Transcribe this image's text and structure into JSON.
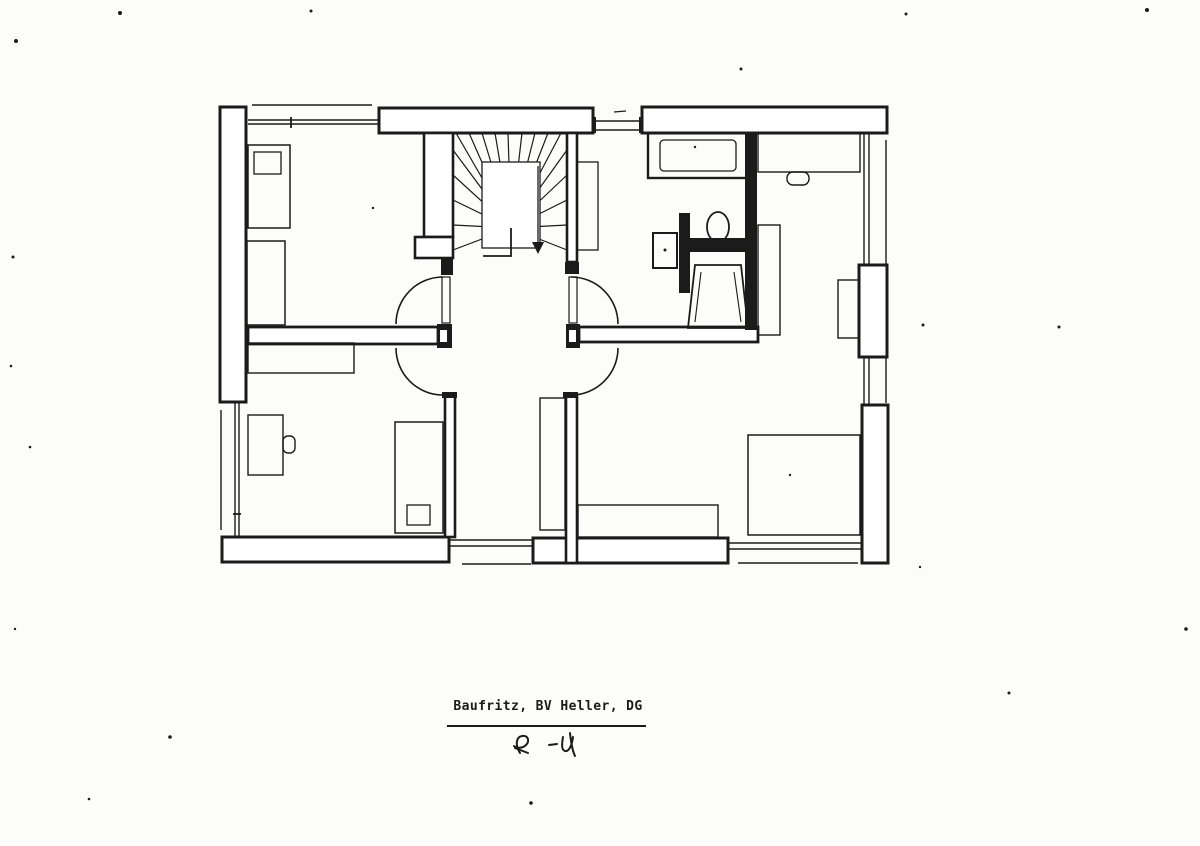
{
  "colors": {
    "paper": "#fcfcfa",
    "ink": "#1b1b1b"
  },
  "footer": {
    "title": "Baufritz, BV Heller, DG",
    "scribble_d": "M520,753 C515,745 516,737 522,736 C528,735 530,741 526,745 C522,749 516,748 514,746 M515,748 L528,753 M549,745 L557,744 M563,737 C562,743 561,750 565,751 C569,752 572,745 573,737 M570,733 C571,741 572,750 575,756"
  },
  "plan": {
    "shapes": [
      {
        "t": "line",
        "n": "roof-edge-top-left",
        "x1": 252,
        "y1": 105,
        "x2": 372,
        "y2": 105,
        "sw": 1.4
      },
      {
        "t": "line",
        "n": "knee-wall-top-left-a",
        "x1": 248,
        "y1": 120,
        "x2": 379,
        "y2": 120,
        "sw": 1.4
      },
      {
        "t": "line",
        "n": "knee-wall-top-left-b",
        "x1": 248,
        "y1": 124,
        "x2": 379,
        "y2": 124,
        "sw": 1.4
      },
      {
        "t": "line",
        "n": "window-tick-top-left",
        "x1": 291,
        "y1": 117,
        "x2": 291,
        "y2": 128,
        "sw": 1.8
      },
      {
        "t": "line",
        "n": "window-top-middle-a",
        "x1": 596,
        "y1": 121,
        "x2": 639,
        "y2": 121,
        "sw": 1.4
      },
      {
        "t": "line",
        "n": "window-top-middle-b",
        "x1": 596,
        "y1": 130,
        "x2": 639,
        "y2": 130,
        "sw": 1.4
      },
      {
        "t": "line",
        "n": "window-tick-top-middle",
        "x1": 614,
        "y1": 112,
        "x2": 626,
        "y2": 111,
        "sw": 1.3
      },
      {
        "t": "line",
        "n": "knee-wall-right-upper-a",
        "x1": 864,
        "y1": 133,
        "x2": 864,
        "y2": 265,
        "sw": 1.4
      },
      {
        "t": "line",
        "n": "knee-wall-right-upper-b",
        "x1": 869,
        "y1": 133,
        "x2": 869,
        "y2": 265,
        "sw": 1.4
      },
      {
        "t": "line",
        "n": "knee-wall-right-mid-a",
        "x1": 864,
        "y1": 357,
        "x2": 864,
        "y2": 405,
        "sw": 1.4
      },
      {
        "t": "line",
        "n": "knee-wall-right-mid-b",
        "x1": 869,
        "y1": 357,
        "x2": 869,
        "y2": 405,
        "sw": 1.4
      },
      {
        "t": "line",
        "n": "roof-edge-right",
        "x1": 886,
        "y1": 140,
        "x2": 886,
        "y2": 403,
        "sw": 1.4
      },
      {
        "t": "line",
        "n": "roof-edge-left-lower",
        "x1": 221,
        "y1": 410,
        "x2": 221,
        "y2": 530,
        "sw": 1.4
      },
      {
        "t": "line",
        "n": "knee-wall-left-lower-a",
        "x1": 235,
        "y1": 403,
        "x2": 235,
        "y2": 537,
        "sw": 1.4
      },
      {
        "t": "line",
        "n": "knee-wall-left-lower-b",
        "x1": 239,
        "y1": 403,
        "x2": 239,
        "y2": 537,
        "sw": 1.4
      },
      {
        "t": "line",
        "n": "window-tick-left-lower",
        "x1": 233,
        "y1": 514,
        "x2": 241,
        "y2": 514,
        "sw": 1.8
      },
      {
        "t": "line",
        "n": "knee-wall-bottom-left-a",
        "x1": 449,
        "y1": 540,
        "x2": 533,
        "y2": 540,
        "sw": 1.4
      },
      {
        "t": "line",
        "n": "knee-wall-bottom-left-b",
        "x1": 449,
        "y1": 546,
        "x2": 533,
        "y2": 546,
        "sw": 1.4
      },
      {
        "t": "line",
        "n": "roof-edge-bottom-left",
        "x1": 462,
        "y1": 564,
        "x2": 531,
        "y2": 564,
        "sw": 1.4
      },
      {
        "t": "line",
        "n": "knee-wall-bottom-right-a",
        "x1": 728,
        "y1": 543,
        "x2": 862,
        "y2": 543,
        "sw": 1.4
      },
      {
        "t": "line",
        "n": "knee-wall-bottom-right-b",
        "x1": 728,
        "y1": 549,
        "x2": 862,
        "y2": 549,
        "sw": 1.4
      },
      {
        "t": "line",
        "n": "roof-edge-bottom-right",
        "x1": 738,
        "y1": 563,
        "x2": 858,
        "y2": 563,
        "sw": 1.4
      },
      {
        "t": "rect",
        "n": "wall-exterior-left",
        "x": 220,
        "y": 107,
        "w": 26,
        "h": 295,
        "f": "#ffffff",
        "sw": 3
      },
      {
        "t": "rect",
        "n": "wall-top-stair",
        "x": 379,
        "y": 108,
        "w": 214,
        "h": 25,
        "f": "#ffffff",
        "sw": 3
      },
      {
        "t": "rect",
        "n": "wall-top-right",
        "x": 642,
        "y": 107,
        "w": 245,
        "h": 26,
        "f": "#ffffff",
        "sw": 3
      },
      {
        "t": "rect",
        "n": "wall-bottom-left",
        "x": 222,
        "y": 537,
        "w": 227,
        "h": 25,
        "f": "#ffffff",
        "sw": 3
      },
      {
        "t": "rect",
        "n": "wall-bottom-middle",
        "x": 533,
        "y": 538,
        "w": 195,
        "h": 25,
        "f": "#ffffff",
        "sw": 3
      },
      {
        "t": "rect",
        "n": "wall-right-dormer-upper",
        "x": 859,
        "y": 265,
        "w": 28,
        "h": 92,
        "f": "#ffffff",
        "sw": 3
      },
      {
        "t": "rect",
        "n": "wall-right-dormer-lower",
        "x": 862,
        "y": 405,
        "w": 26,
        "h": 158,
        "f": "#ffffff",
        "sw": 3
      },
      {
        "t": "rect",
        "n": "wall-stair-left",
        "x": 424,
        "y": 133,
        "w": 29,
        "h": 104,
        "f": "#ffffff",
        "sw": 2.6
      },
      {
        "t": "rect",
        "n": "wall-stair-left-jog",
        "x": 415,
        "y": 237,
        "w": 38,
        "h": 21,
        "f": "#ffffff",
        "sw": 2.6
      },
      {
        "t": "rect",
        "n": "wall-stair-right",
        "x": 567,
        "y": 133,
        "w": 10,
        "h": 129,
        "f": "#ffffff",
        "sw": 2.6
      },
      {
        "t": "rect",
        "n": "wall-mid-left",
        "x": 248,
        "y": 327,
        "w": 190,
        "h": 17,
        "f": "#ffffff",
        "sw": 2.8
      },
      {
        "t": "rect",
        "n": "wall-mid-right",
        "x": 579,
        "y": 327,
        "w": 179,
        "h": 15,
        "f": "#ffffff",
        "sw": 2.8
      },
      {
        "t": "rect",
        "n": "wall-lower-left",
        "x": 445,
        "y": 395,
        "w": 10,
        "h": 142,
        "f": "#ffffff",
        "sw": 2.6
      },
      {
        "t": "rect",
        "n": "wall-lower-right",
        "x": 566,
        "y": 395,
        "w": 11,
        "h": 168,
        "f": "#ffffff",
        "sw": 2.6
      },
      {
        "t": "rect",
        "n": "door-jamb",
        "x": 441,
        "y": 258,
        "w": 12,
        "h": 17,
        "f": "ink"
      },
      {
        "t": "rect",
        "n": "door-jamb",
        "x": 565,
        "y": 262,
        "w": 14,
        "h": 12,
        "f": "ink"
      },
      {
        "t": "rect",
        "n": "door-jamb",
        "x": 437,
        "y": 324,
        "w": 15,
        "h": 24,
        "f": "ink"
      },
      {
        "t": "rect",
        "n": "door-jamb",
        "x": 566,
        "y": 324,
        "w": 14,
        "h": 24,
        "f": "ink"
      },
      {
        "t": "rect",
        "n": "door-jamb",
        "x": 442,
        "y": 392,
        "w": 15,
        "h": 6,
        "f": "ink"
      },
      {
        "t": "rect",
        "n": "door-jamb",
        "x": 563,
        "y": 392,
        "w": 15,
        "h": 6,
        "f": "ink"
      },
      {
        "t": "rect",
        "n": "jamb-notch",
        "x": 440,
        "y": 330,
        "w": 7,
        "h": 12,
        "f": "#ffffff"
      },
      {
        "t": "rect",
        "n": "jamb-notch",
        "x": 569,
        "y": 330,
        "w": 7,
        "h": 12,
        "f": "#ffffff"
      },
      {
        "t": "rect",
        "n": "wall-bath-right",
        "x": 745,
        "y": 133,
        "w": 12,
        "h": 197,
        "f": "ink"
      },
      {
        "t": "rect",
        "n": "wall-bath-partition-vertical",
        "x": 679,
        "y": 213,
        "w": 11,
        "h": 80,
        "f": "ink"
      },
      {
        "t": "rect",
        "n": "wall-bath-partition-horizontal",
        "x": 690,
        "y": 238,
        "w": 56,
        "h": 14,
        "f": "ink"
      },
      {
        "t": "rect",
        "n": "window-jamb-top",
        "x": 592,
        "y": 117,
        "w": 4,
        "h": 16,
        "f": "ink"
      },
      {
        "t": "rect",
        "n": "window-jamb-top",
        "x": 639,
        "y": 117,
        "w": 4,
        "h": 16,
        "f": "ink"
      },
      {
        "t": "line",
        "n": "stair-tread",
        "x1": 511,
        "y1": 228,
        "x2": 456,
        "y2": 133,
        "sw": 1.2
      },
      {
        "t": "line",
        "n": "stair-tread",
        "x1": 511,
        "y1": 228,
        "x2": 469,
        "y2": 133,
        "sw": 1.2
      },
      {
        "t": "line",
        "n": "stair-tread",
        "x1": 511,
        "y1": 228,
        "x2": 482,
        "y2": 133,
        "sw": 1.2
      },
      {
        "t": "line",
        "n": "stair-tread",
        "x1": 511,
        "y1": 228,
        "x2": 495,
        "y2": 133,
        "sw": 1.2
      },
      {
        "t": "line",
        "n": "stair-tread",
        "x1": 511,
        "y1": 228,
        "x2": 508,
        "y2": 133,
        "sw": 1.2
      },
      {
        "t": "line",
        "n": "stair-tread",
        "x1": 511,
        "y1": 228,
        "x2": 522,
        "y2": 133,
        "sw": 1.2
      },
      {
        "t": "line",
        "n": "stair-tread",
        "x1": 511,
        "y1": 228,
        "x2": 535,
        "y2": 133,
        "sw": 1.2
      },
      {
        "t": "line",
        "n": "stair-tread",
        "x1": 511,
        "y1": 228,
        "x2": 548,
        "y2": 133,
        "sw": 1.2
      },
      {
        "t": "line",
        "n": "stair-tread",
        "x1": 511,
        "y1": 228,
        "x2": 561,
        "y2": 133,
        "sw": 1.2
      },
      {
        "t": "line",
        "n": "stair-tread",
        "x1": 511,
        "y1": 228,
        "x2": 453,
        "y2": 150,
        "sw": 1.2
      },
      {
        "t": "line",
        "n": "stair-tread",
        "x1": 511,
        "y1": 228,
        "x2": 453,
        "y2": 175,
        "sw": 1.2
      },
      {
        "t": "line",
        "n": "stair-tread",
        "x1": 511,
        "y1": 228,
        "x2": 453,
        "y2": 200,
        "sw": 1.2
      },
      {
        "t": "line",
        "n": "stair-tread",
        "x1": 511,
        "y1": 228,
        "x2": 453,
        "y2": 225,
        "sw": 1.2
      },
      {
        "t": "line",
        "n": "stair-tread",
        "x1": 511,
        "y1": 228,
        "x2": 453,
        "y2": 250,
        "sw": 1.2
      },
      {
        "t": "line",
        "n": "stair-tread",
        "x1": 511,
        "y1": 228,
        "x2": 567,
        "y2": 150,
        "sw": 1.2
      },
      {
        "t": "line",
        "n": "stair-tread",
        "x1": 511,
        "y1": 228,
        "x2": 567,
        "y2": 175,
        "sw": 1.2
      },
      {
        "t": "line",
        "n": "stair-tread",
        "x1": 511,
        "y1": 228,
        "x2": 567,
        "y2": 200,
        "sw": 1.2
      },
      {
        "t": "line",
        "n": "stair-tread",
        "x1": 511,
        "y1": 228,
        "x2": 567,
        "y2": 225,
        "sw": 1.2
      },
      {
        "t": "line",
        "n": "stair-tread",
        "x1": 511,
        "y1": 228,
        "x2": 567,
        "y2": 250,
        "sw": 1.2
      },
      {
        "t": "rect",
        "n": "stair-well",
        "x": 482,
        "y": 162,
        "w": 58,
        "h": 86,
        "f": "#ffffff",
        "sw": 1.3
      },
      {
        "t": "pline",
        "n": "stair-flight-divider",
        "p": "511,228 511,256 483,256",
        "sw": 1.8
      },
      {
        "t": "line",
        "n": "stair-walk-line",
        "x1": 538,
        "y1": 166,
        "x2": 538,
        "y2": 244,
        "sw": 1.3
      },
      {
        "t": "poly",
        "n": "stair-direction-arrow",
        "p": "532,242 544,242 538,254",
        "f": "ink"
      },
      {
        "t": "rect",
        "n": "bed",
        "x": 248,
        "y": 145,
        "w": 42,
        "h": 83,
        "sw": 1.5
      },
      {
        "t": "rect",
        "n": "bed-pillow",
        "x": 254,
        "y": 152,
        "w": 27,
        "h": 22,
        "sw": 1.3
      },
      {
        "t": "rect",
        "n": "bed",
        "x": 247,
        "y": 241,
        "w": 38,
        "h": 84,
        "sw": 1.5
      },
      {
        "t": "rect",
        "n": "bath-shelf",
        "x": 577,
        "y": 162,
        "w": 21,
        "h": 88,
        "sw": 1.3
      },
      {
        "t": "rect",
        "n": "bathtub",
        "x": 648,
        "y": 133,
        "w": 99,
        "h": 45,
        "sw": 2.4
      },
      {
        "t": "rect",
        "n": "bathtub-inner",
        "x": 660,
        "y": 140,
        "w": 76,
        "h": 31,
        "rx": 4,
        "sw": 1.3
      },
      {
        "t": "rect",
        "n": "sink",
        "x": 653,
        "y": 233,
        "w": 24,
        "h": 35,
        "sw": 2
      },
      {
        "t": "dot",
        "n": "sink-drain",
        "x": 665,
        "y": 250,
        "r": 1.5,
        "f": "ink"
      },
      {
        "t": "ellipse",
        "n": "toilet",
        "cx": 718,
        "cy": 227,
        "rx": 11,
        "ry": 15,
        "sw": 1.8
      },
      {
        "t": "poly",
        "n": "shower-tray",
        "p": "695,265 741,265 748,328 688,328",
        "sw": 1.8
      },
      {
        "t": "line",
        "n": "shower-tray-inner",
        "x1": 701,
        "y1": 272,
        "x2": 695,
        "y2": 322,
        "sw": 1.1
      },
      {
        "t": "line",
        "n": "shower-tray-inner",
        "x1": 734,
        "y1": 272,
        "x2": 741,
        "y2": 322,
        "sw": 1.1
      },
      {
        "t": "rect",
        "n": "cabinet",
        "x": 248,
        "y": 343,
        "w": 106,
        "h": 30,
        "sw": 1.4
      },
      {
        "t": "rect",
        "n": "desk",
        "x": 248,
        "y": 415,
        "w": 35,
        "h": 60,
        "sw": 1.4
      },
      {
        "t": "rect",
        "n": "chair",
        "x": 283,
        "y": 436,
        "w": 12,
        "h": 17,
        "rx": 5,
        "sw": 1.4
      },
      {
        "t": "rect",
        "n": "bed",
        "x": 395,
        "y": 422,
        "w": 48,
        "h": 111,
        "sw": 1.5
      },
      {
        "t": "rect",
        "n": "bed-pillow",
        "x": 407,
        "y": 505,
        "w": 23,
        "h": 20,
        "sw": 1.3
      },
      {
        "t": "rect",
        "n": "desk",
        "x": 758,
        "y": 133,
        "w": 102,
        "h": 39,
        "sw": 1.4
      },
      {
        "t": "rect",
        "n": "chair",
        "x": 787,
        "y": 172,
        "w": 22,
        "h": 13,
        "rx": 6,
        "sw": 1.4
      },
      {
        "t": "rect",
        "n": "shelf",
        "x": 758,
        "y": 225,
        "w": 22,
        "h": 110,
        "sw": 1.4
      },
      {
        "t": "rect",
        "n": "desk",
        "x": 838,
        "y": 280,
        "w": 21,
        "h": 58,
        "sw": 1.4
      },
      {
        "t": "rect",
        "n": "wardrobe",
        "x": 540,
        "y": 398,
        "w": 25,
        "h": 132,
        "sw": 1.4
      },
      {
        "t": "rect",
        "n": "sideboard",
        "x": 578,
        "y": 505,
        "w": 140,
        "h": 32,
        "sw": 1.4
      },
      {
        "t": "rect",
        "n": "bed",
        "x": 748,
        "y": 435,
        "w": 112,
        "h": 100,
        "sw": 1.5
      },
      {
        "t": "rect",
        "n": "door-leaf",
        "x": 442,
        "y": 277,
        "w": 8,
        "h": 46,
        "sw": 1.2
      },
      {
        "t": "rect",
        "n": "door-leaf",
        "x": 569,
        "y": 277,
        "w": 8,
        "h": 46,
        "sw": 1.2
      },
      {
        "t": "path",
        "n": "door-swing-arc",
        "d": "M443,277 A47 47 0 0 0 396,324",
        "sw": 1.6
      },
      {
        "t": "path",
        "n": "door-swing-arc",
        "d": "M571,277 A47 47 0 0 1 618,324",
        "sw": 1.6
      },
      {
        "t": "path",
        "n": "door-swing-arc",
        "d": "M396,348 A47 47 0 0 0 443,395",
        "sw": 1.6
      },
      {
        "t": "path",
        "n": "door-swing-arc",
        "d": "M618,348 A47 47 0 0 1 571,395",
        "sw": 1.6
      },
      {
        "t": "dot",
        "n": "scan-speck",
        "x": 373,
        "y": 208,
        "r": 1.2,
        "f": "ink"
      },
      {
        "t": "dot",
        "n": "scan-speck",
        "x": 695,
        "y": 147,
        "r": 1.2,
        "f": "ink"
      },
      {
        "t": "dot",
        "n": "scan-speck",
        "x": 790,
        "y": 475,
        "r": 1.2,
        "f": "ink"
      },
      {
        "t": "dot",
        "n": "scan-speck",
        "x": 923,
        "y": 325,
        "r": 1.5,
        "f": "ink"
      },
      {
        "t": "dot",
        "n": "scan-speck",
        "x": 16,
        "y": 41,
        "r": 2,
        "f": "ink"
      },
      {
        "t": "dot",
        "n": "scan-speck",
        "x": 120,
        "y": 13,
        "r": 2,
        "f": "ink"
      },
      {
        "t": "dot",
        "n": "scan-speck",
        "x": 311,
        "y": 11,
        "r": 1.5,
        "f": "ink"
      },
      {
        "t": "dot",
        "n": "scan-speck",
        "x": 741,
        "y": 69,
        "r": 1.5,
        "f": "ink"
      },
      {
        "t": "dot",
        "n": "scan-speck",
        "x": 906,
        "y": 14,
        "r": 1.5,
        "f": "ink"
      },
      {
        "t": "dot",
        "n": "scan-speck",
        "x": 1147,
        "y": 10,
        "r": 2,
        "f": "ink"
      },
      {
        "t": "dot",
        "n": "scan-speck",
        "x": 13,
        "y": 257,
        "r": 1.5,
        "f": "ink"
      },
      {
        "t": "dot",
        "n": "scan-speck",
        "x": 11,
        "y": 366,
        "r": 1.3,
        "f": "ink"
      },
      {
        "t": "dot",
        "n": "scan-speck",
        "x": 1059,
        "y": 327,
        "r": 1.5,
        "f": "ink"
      },
      {
        "t": "dot",
        "n": "scan-speck",
        "x": 30,
        "y": 447,
        "r": 1.3,
        "f": "ink"
      },
      {
        "t": "dot",
        "n": "scan-speck",
        "x": 170,
        "y": 737,
        "r": 1.8,
        "f": "ink"
      },
      {
        "t": "dot",
        "n": "scan-speck",
        "x": 1009,
        "y": 693,
        "r": 1.5,
        "f": "ink"
      },
      {
        "t": "dot",
        "n": "scan-speck",
        "x": 1186,
        "y": 629,
        "r": 1.8,
        "f": "ink"
      },
      {
        "t": "dot",
        "n": "scan-speck",
        "x": 89,
        "y": 799,
        "r": 1.3,
        "f": "ink"
      },
      {
        "t": "dot",
        "n": "scan-speck",
        "x": 531,
        "y": 803,
        "r": 1.8,
        "f": "ink"
      },
      {
        "t": "dot",
        "n": "scan-speck",
        "x": 15,
        "y": 629,
        "r": 1.2,
        "f": "ink"
      },
      {
        "t": "dot",
        "n": "scan-speck",
        "x": 920,
        "y": 567,
        "r": 1.2,
        "f": "ink"
      }
    ]
  }
}
